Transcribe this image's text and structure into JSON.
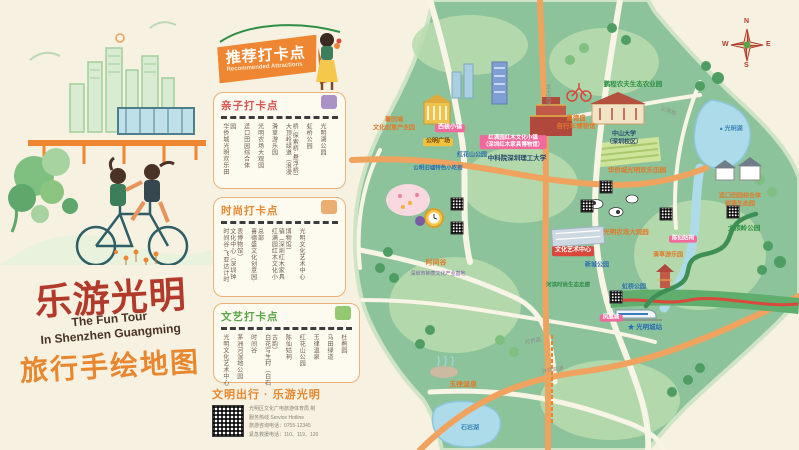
{
  "cover": {
    "title_cn": "乐游光明",
    "title_en": "The Fun Tour\nIn Shenzhen Guangming",
    "subtitle_cn": "旅行手绘地图"
  },
  "banner": {
    "title": "推荐打卡点",
    "subtitle": "Recommended Attractions"
  },
  "lists": [
    {
      "title": "亲子打卡点",
      "color": "#d9534f",
      "icon": "stroller-icon",
      "items": [
        "华侨城光明欢乐田园",
        "迳口田园综合体",
        "光明农场大观园",
        "滑草游乐园",
        "大顶岭绿道（浪漫桥·探索桥·悬浮桥）",
        "虹桥公园",
        "光明湖公园"
      ]
    },
    {
      "title": "时尚打卡点",
      "color": "#e8872e",
      "icon": "watch-icon",
      "items": [
        "时间谷·飞亚达计时文化中心（深圳钟表博物馆）",
        "喜德盛文化创意园·总部",
        "红满园红木文化小镇（深圳红木家具博物馆）",
        "光明文化艺术中心"
      ]
    },
    {
      "title": "文艺打卡点",
      "color": "#5aa546",
      "icon": "sneaker-icon",
      "items": [
        "光明文化艺术中心",
        "茅洲河湿地公园",
        "时间谷",
        "白花写生村（白石古韵）",
        "陈仙姑祠",
        "红花山公园",
        "玉律温泉",
        "马田绿道",
        "杜鹃园"
      ]
    }
  ],
  "footer": {
    "slogan": "文明出行 · 乐游光明",
    "issuer": "光明区文化广电旅游体育局 制",
    "hotline_label": "服务热线  Service Hotline",
    "hotline1": "旅游咨询电话：0755-12345",
    "hotline2": "紧急救援电话：110、119、120"
  },
  "map": {
    "compass": {
      "n": "N",
      "e": "E",
      "s": "S",
      "w": "W"
    },
    "colors": {
      "land": "#8cc39b",
      "land_light": "#b9dcae",
      "forest": "#4e9e63",
      "water": "#aedbea",
      "road_major": "#f0a35e",
      "road_minor": "#f8f4e6",
      "greenway": "#3e8f55",
      "red_bridge": "#d9483b",
      "accent_orange": "#e8872e",
      "accent_red": "#b23a2b"
    },
    "labels": [
      {
        "text": "薯田埔\n文化创意产业园",
        "x": 394,
        "y": 125,
        "cls": "ml-orange",
        "size": 6
      },
      {
        "text": "西装小镇",
        "x": 450,
        "y": 128,
        "cls": "ml-pink",
        "size": 6
      },
      {
        "text": "公明广场",
        "x": 438,
        "y": 142,
        "cls": "ml-yellow",
        "size": 6
      },
      {
        "text": "公明旧墟特色小吃街",
        "x": 438,
        "y": 169,
        "cls": "ml-blue",
        "size": 5.5
      },
      {
        "text": "红花山公园",
        "x": 472,
        "y": 156,
        "cls": "ml-blue",
        "size": 6
      },
      {
        "text": "红满园红木文化小镇\n（深圳红木家具博物馆）",
        "x": 513,
        "y": 142,
        "cls": "ml-pink",
        "size": 5.5
      },
      {
        "text": "中科院深圳理工大学",
        "x": 517,
        "y": 159,
        "cls": "ml-dark",
        "size": 6.5
      },
      {
        "text": "鹏程农夫生态农业园",
        "x": 633,
        "y": 85,
        "cls": "ml-green",
        "size": 6.5
      },
      {
        "text": "喜德盛\n自行车博物馆",
        "x": 576,
        "y": 123,
        "cls": "ml-orange",
        "size": 6.5
      },
      {
        "text": "中山大学\n（深圳校区）",
        "x": 624,
        "y": 139,
        "cls": "ml-dark",
        "size": 6
      },
      {
        "text": "● 光明湖",
        "x": 731,
        "y": 130,
        "cls": "ml-water",
        "size": 6
      },
      {
        "text": "华侨城光明欢乐田园",
        "x": 637,
        "y": 171,
        "cls": "ml-orange",
        "size": 6.5
      },
      {
        "text": "迳口田园综合体\n树德生态园",
        "x": 740,
        "y": 201,
        "cls": "ml-orange",
        "size": 6
      },
      {
        "text": "大顶岭公园",
        "x": 744,
        "y": 229,
        "cls": "ml-green",
        "size": 6.5
      },
      {
        "text": "光明农场大观园",
        "x": 626,
        "y": 233,
        "cls": "ml-orange",
        "size": 6.5
      },
      {
        "text": "陈仙姑祠",
        "x": 683,
        "y": 239,
        "cls": "ml-pink",
        "size": 5.5
      },
      {
        "text": "滑草游乐园",
        "x": 668,
        "y": 256,
        "cls": "ml-orange",
        "size": 6
      },
      {
        "text": "时间谷",
        "x": 436,
        "y": 264,
        "cls": "ml-orange",
        "size": 7
      },
      {
        "text": "深圳市钟表文化产业基地",
        "x": 438,
        "y": 274,
        "cls": "ml-purple",
        "size": 5
      },
      {
        "text": "文化艺术中心",
        "x": 573,
        "y": 251,
        "cls": "ml-red",
        "size": 6
      },
      {
        "text": "新城公园",
        "x": 597,
        "y": 266,
        "cls": "ml-blue",
        "size": 6
      },
      {
        "text": "河滨时尚生态走廊",
        "x": 568,
        "y": 286,
        "cls": "ml-green",
        "size": 5.5
      },
      {
        "text": "虹桥公园",
        "x": 634,
        "y": 288,
        "cls": "ml-blue",
        "size": 6
      },
      {
        "text": "凤凰城",
        "x": 611,
        "y": 318,
        "cls": "ml-pink",
        "size": 5.5
      },
      {
        "text": "★ 光明城站",
        "x": 645,
        "y": 328,
        "cls": "ml-blue",
        "size": 6.5
      },
      {
        "text": "玉律温泉",
        "x": 463,
        "y": 386,
        "cls": "ml-orange",
        "size": 7
      },
      {
        "text": "石岩湖",
        "x": 470,
        "y": 429,
        "cls": "ml-water",
        "size": 6
      },
      {
        "text": "龙大高速",
        "x": 547,
        "y": 95,
        "cls": "ml-road",
        "size": 5.5,
        "vert": true
      },
      {
        "text": "光侨路",
        "x": 533,
        "y": 342,
        "cls": "ml-road",
        "size": 5.5,
        "rot": -8
      },
      {
        "text": "外环高速",
        "x": 553,
        "y": 371,
        "cls": "ml-road",
        "size": 5.5,
        "rot": -10
      },
      {
        "text": "公常路",
        "x": 668,
        "y": 112,
        "cls": "ml-road",
        "size": 5.5,
        "rot": 22
      }
    ],
    "qr_positions": [
      {
        "x": 457,
        "y": 204
      },
      {
        "x": 457,
        "y": 228
      },
      {
        "x": 606,
        "y": 187
      },
      {
        "x": 666,
        "y": 214
      },
      {
        "x": 733,
        "y": 212
      },
      {
        "x": 616,
        "y": 297
      },
      {
        "x": 587,
        "y": 206
      }
    ]
  }
}
